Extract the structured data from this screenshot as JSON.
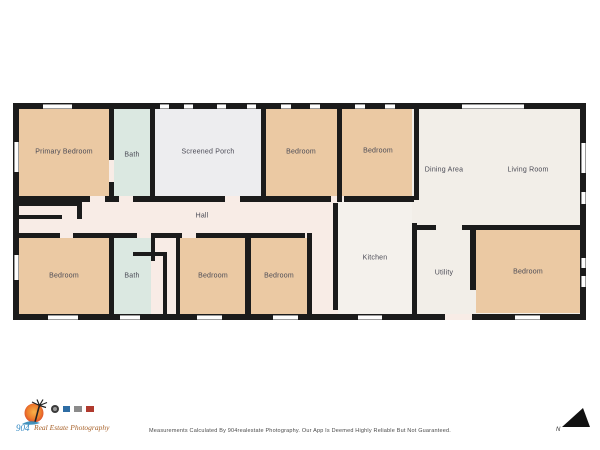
{
  "floorplan": {
    "rooms": [
      {
        "id": "primary-bedroom",
        "label": "Primary Bedroom"
      },
      {
        "id": "bath-top",
        "label": "Bath"
      },
      {
        "id": "screened-porch",
        "label": "Screened Porch"
      },
      {
        "id": "bedroom-top-1",
        "label": "Bedroom"
      },
      {
        "id": "bedroom-top-2",
        "label": "Bedroom"
      },
      {
        "id": "dining-area",
        "label": "Dining Area"
      },
      {
        "id": "living-room",
        "label": "Living Room"
      },
      {
        "id": "hall",
        "label": "Hall"
      },
      {
        "id": "bedroom-left",
        "label": "Bedroom"
      },
      {
        "id": "bath-bottom",
        "label": "Bath"
      },
      {
        "id": "bedroom-bottom-1",
        "label": "Bedroom"
      },
      {
        "id": "bedroom-bottom-2",
        "label": "Bedroom"
      },
      {
        "id": "kitchen",
        "label": "Kitchen"
      },
      {
        "id": "utility",
        "label": "Utility"
      },
      {
        "id": "bedroom-right",
        "label": "Bedroom"
      }
    ],
    "colors": {
      "bedroom": "#ebc9a3",
      "bath": "#dbe8e1",
      "porch": "#ededef",
      "common": "#f2eee8",
      "kitchen": "#f4f1ec",
      "hall": "#f8ece6",
      "wall": "#1b1b1b"
    }
  },
  "footer": {
    "logo_mark": "904",
    "logo_script": "Real Estate Photography",
    "disclaimer": "Measurements Calculated By 904realestate Photography. Our App Is Deemed Highly Reliable But Not Guaranteed.",
    "compass_label": "N"
  }
}
